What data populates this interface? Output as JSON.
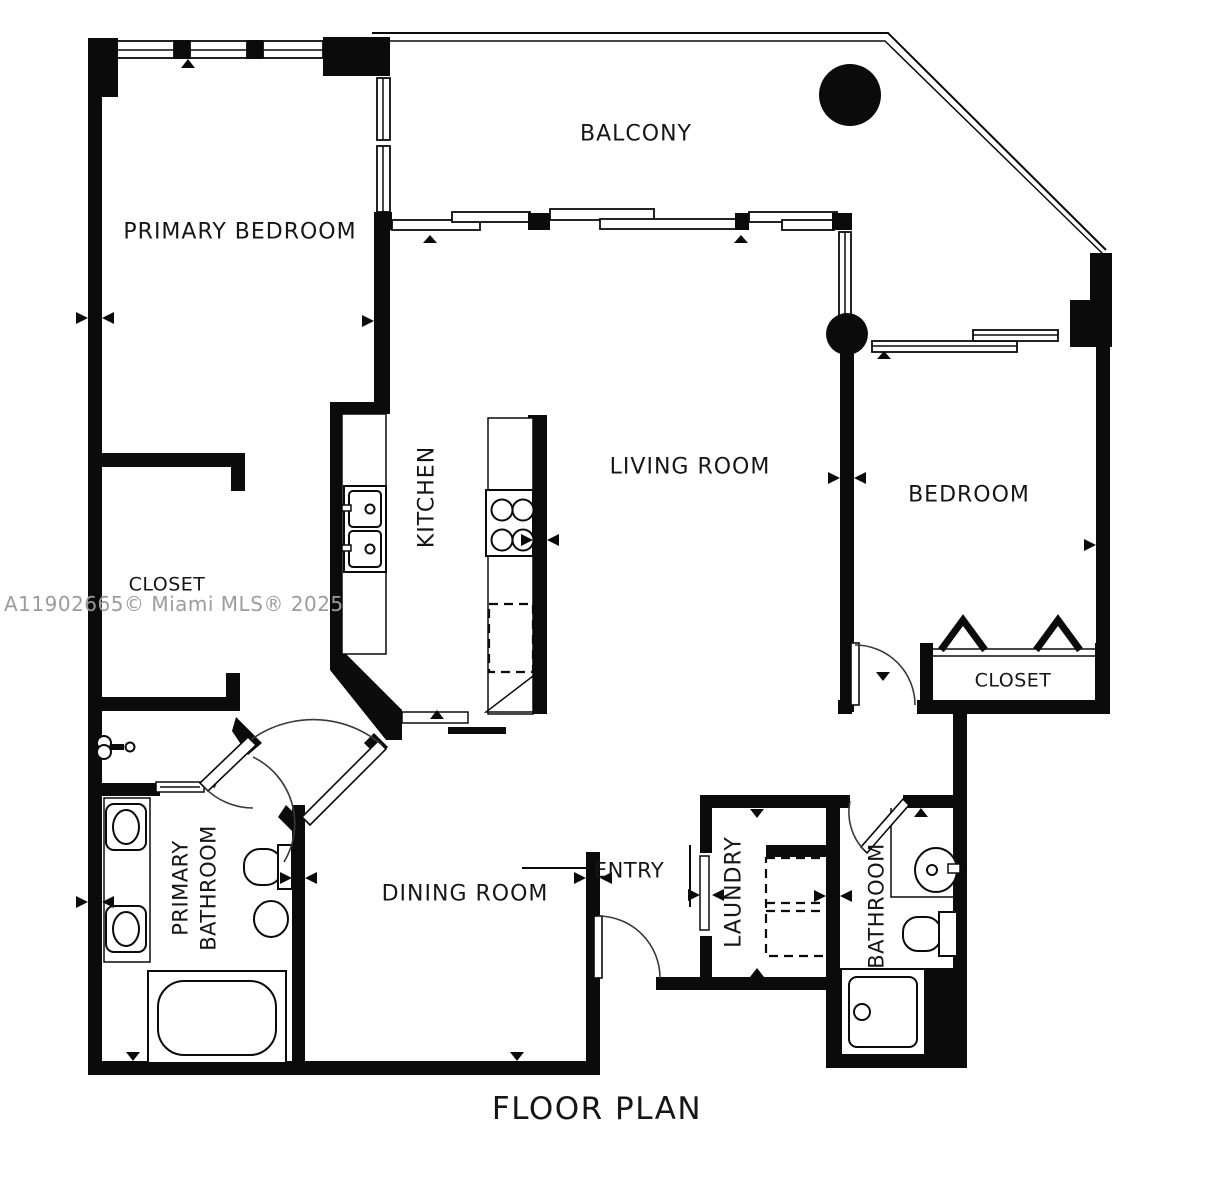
{
  "title": "FLOOR PLAN",
  "watermark": "A11902665© Miami MLS® 2025",
  "colors": {
    "walls": "#0b0b0b",
    "background": "#ffffff",
    "watermark_text": "#9c9c9c",
    "label_text": "#161616"
  },
  "rooms": {
    "balcony": {
      "label": "BALCONY"
    },
    "primary_bedroom": {
      "label": "PRIMARY BEDROOM"
    },
    "living_room": {
      "label": "LIVING ROOM"
    },
    "kitchen": {
      "label": "KITCHEN"
    },
    "bedroom": {
      "label": "BEDROOM"
    },
    "bedroom_closet": {
      "label": "CLOSET"
    },
    "primary_closet": {
      "label": "CLOSET"
    },
    "primary_bathroom": {
      "label_line1": "PRIMARY",
      "label_line2": "BATHROOM"
    },
    "dining_room": {
      "label": "DINING ROOM"
    },
    "entry": {
      "label": "ENTRY"
    },
    "laundry": {
      "label": "LAUNDRY"
    },
    "bathroom": {
      "label": "BATHROOM"
    }
  },
  "fixtures": [
    "kitchen-double-sink",
    "cooktop",
    "refrigerator-dashed",
    "dishwasher-door",
    "double-vanity",
    "bathtub",
    "toilet",
    "bidet-oval",
    "wall-faucet",
    "stacked-washer-dryer-dashed",
    "bathroom-sink",
    "shower-stall",
    "structural-column-large",
    "structural-column-small",
    "sliding-glass-doors",
    "windows",
    "bifold-closet-doors",
    "entry-door-swing",
    "bedroom-door-swing",
    "bathroom-door-swing",
    "angled-double-doors"
  ]
}
